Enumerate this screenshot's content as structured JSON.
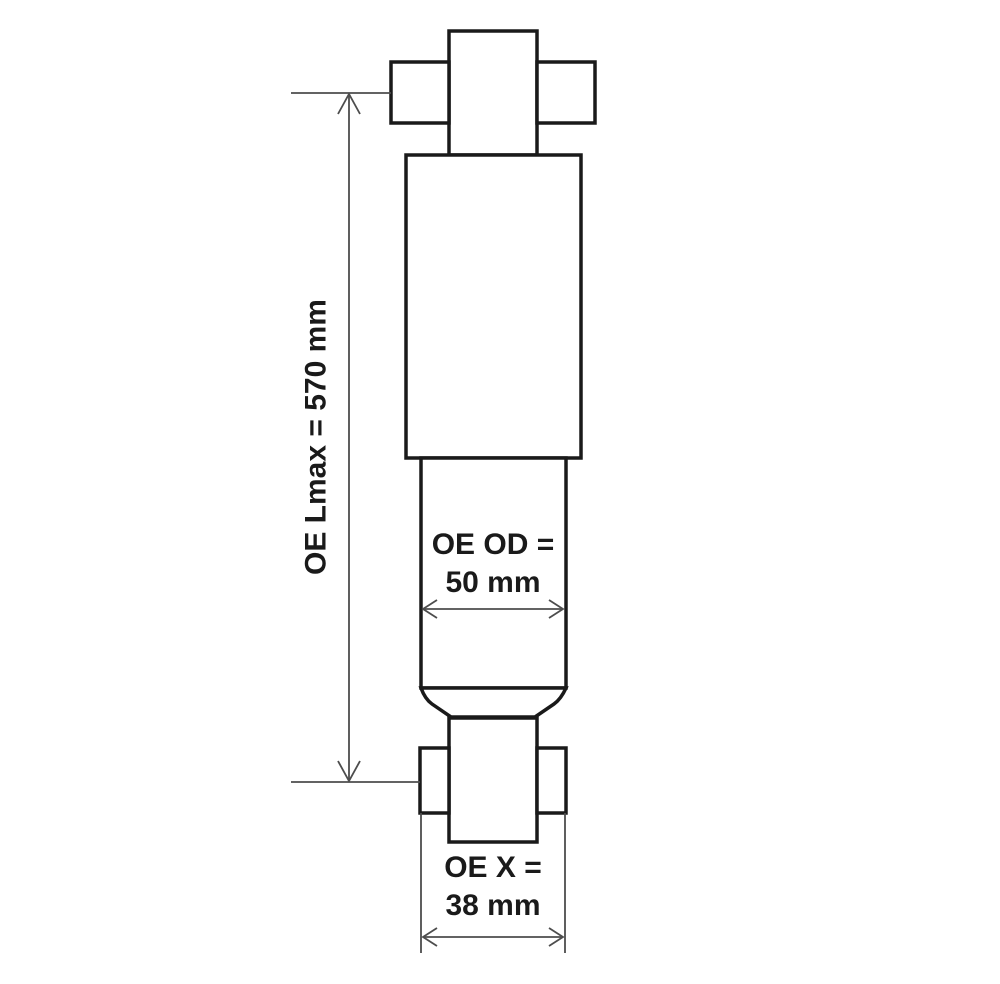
{
  "diagram": {
    "labels": {
      "lmax": "OE Lmax = 570 mm",
      "od_line1": "OE OD =",
      "od_line2": "50 mm",
      "x_line1": "OE X =",
      "x_line2": "38 mm"
    },
    "values": {
      "lmax_mm": 570,
      "od_mm": 50,
      "x_mm": 38
    },
    "colors": {
      "outline": "#1a1a1a",
      "dimension": "#4d4d4d",
      "text": "#1a1a1a",
      "background": "#ffffff"
    }
  }
}
